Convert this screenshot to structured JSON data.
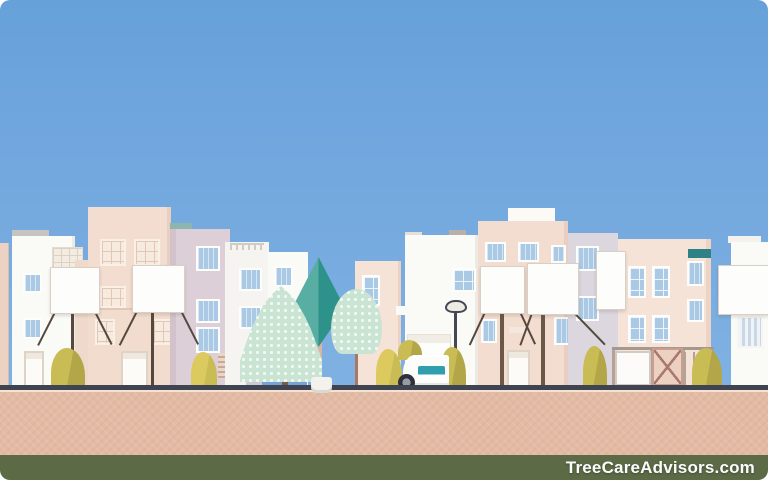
{
  "watermark": {
    "text": "TreeCareAdvisors.com"
  },
  "palette": {
    "sky_top": "#67a1da",
    "sky_bottom": "#80b1e3",
    "cream_wall": "#f3ddd0",
    "cream_wall_light": "#f6e3d7",
    "cream_wall_deep": "#ecd2c2",
    "cream_front": "#f2dcce",
    "white_wall": "#fafaf7",
    "white_wall_dim": "#f5f4f1",
    "lavender_wall": "#ddcfd8",
    "lavender_wall2": "#dcd6de",
    "window_blue": "#aac9e4",
    "window_cream": "#f7eade",
    "window_frame": "#fdfdfb",
    "panel_white": "#fdfdfc",
    "panel_edge": "#d8d0c7",
    "teal_left": "#58aea2",
    "teal_right": "#2d938a",
    "teal_roof_light": "#8db6b1",
    "teal_roof_dark": "#2f8188",
    "leaf_base": "#c9e4d3",
    "leaf_dot": "#f2f9f4",
    "trunk_brown": "#7b5a48",
    "trunk_tan": "#d8b6a4",
    "trunk_dark": "#55493f",
    "trunk_red": "#a87960",
    "bush_olive": "#c9bc55",
    "bush_olive_dark": "#b2a648",
    "bush_yellow": "#ddca5e",
    "wall_blue": "#76a3d4",
    "wall_lavender": "#cfc9d5",
    "lamp_metal": "#454854",
    "lamp_glass": "#edece4",
    "car_body": "#fcfcfa",
    "car_glass": "#2f9fae",
    "wheel": "#30303a",
    "wheel_hub": "#969ca4",
    "pot": "#f4f2ec",
    "fence_peach": "#ecd0c2",
    "fence_line": "#a8796c",
    "fence_post": "#b5a294",
    "gate_white": "#fcfbf9",
    "curb": "#3f4450",
    "curb_light": "#f4e3d5",
    "road": "#e3bba5",
    "strip": "#5c6a46",
    "watermark_color": "#fdfdfd"
  }
}
